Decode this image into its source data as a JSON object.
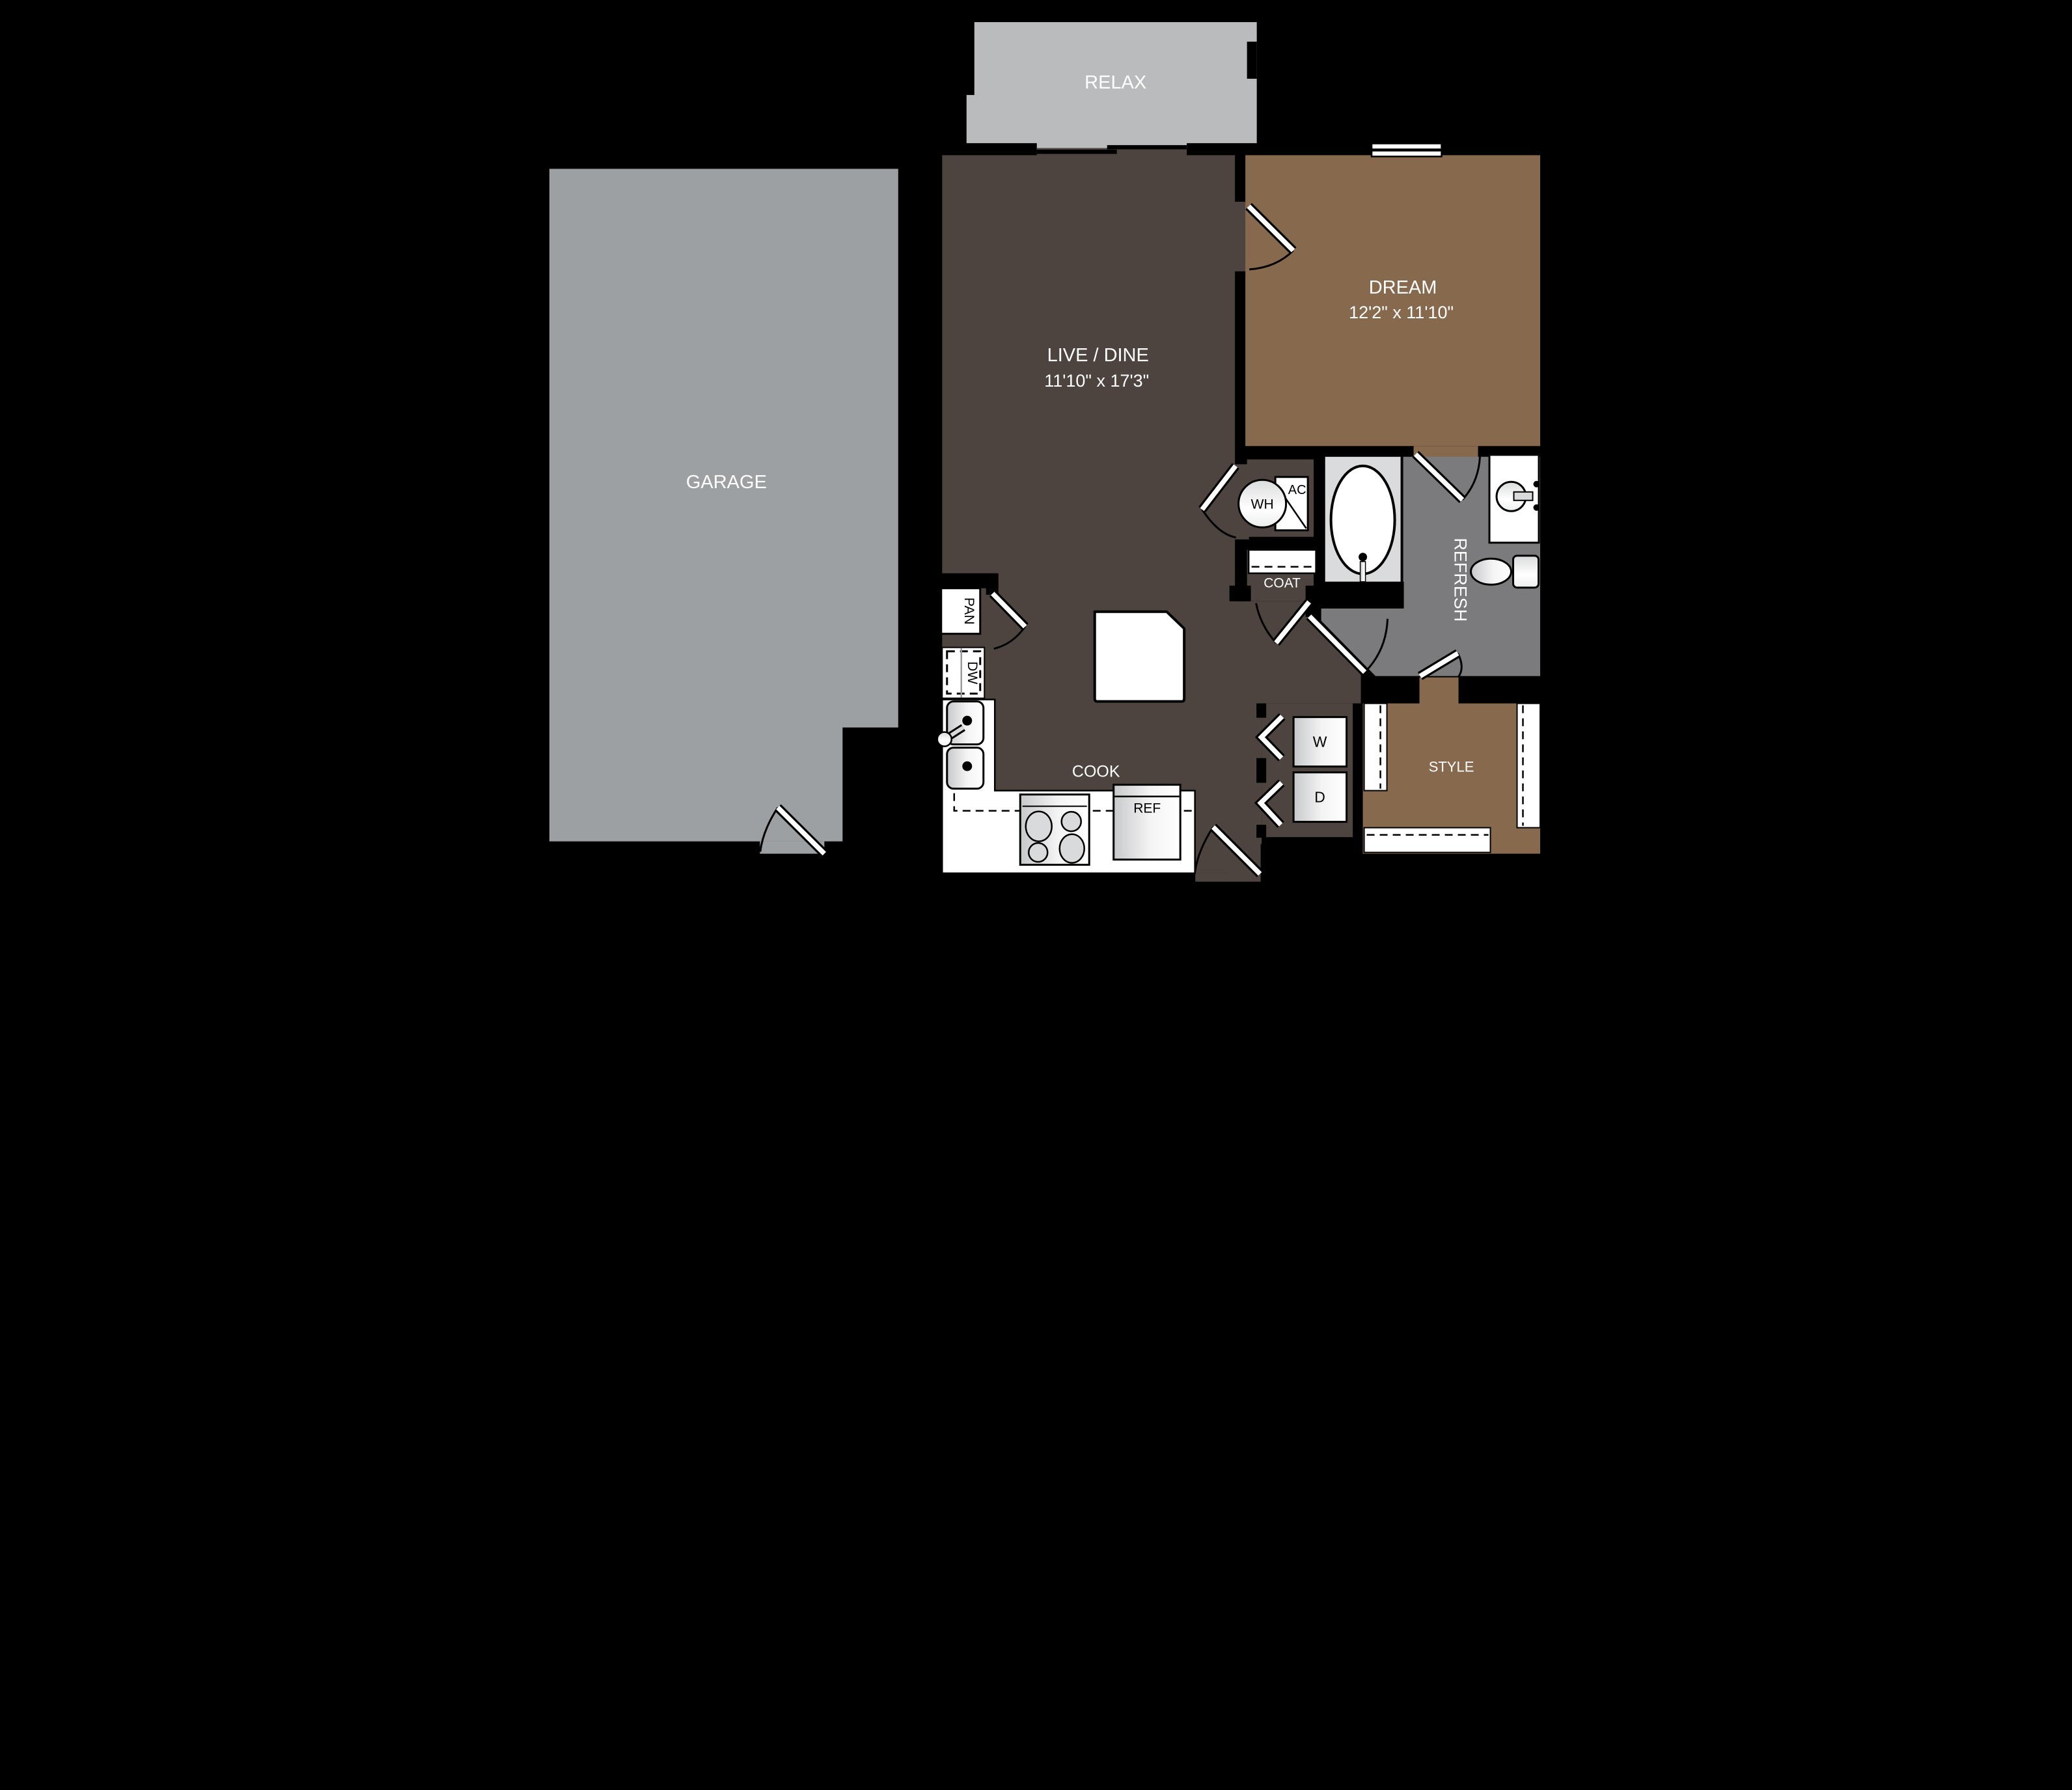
{
  "plan_title": "One-bedroom apartment floor plan with attached garage",
  "colors": {
    "background": "#000000",
    "relax_floor": "#b9bbbd",
    "garage_floor": "#9da0a2",
    "dark_floor": "#4d443f",
    "dream_floor": "#876a4e",
    "bath_floor": "#7b7b7d",
    "tub_niche": "#dadbdd",
    "fixture_white": "#ffffff",
    "label_white": "#ffffff",
    "label_black": "#000000"
  },
  "rooms": {
    "relax": {
      "label": "RELAX"
    },
    "garage": {
      "label": "GARAGE"
    },
    "live_dine": {
      "label": "LIVE / DINE",
      "dims": "11'10\" x 17'3\""
    },
    "dream": {
      "label": "DREAM",
      "dims": "12'2\" x 11'10\""
    },
    "cook": {
      "label": "COOK"
    },
    "coat": {
      "label": "COAT"
    },
    "refresh": {
      "label": "REFRESH"
    },
    "style": {
      "label": "STYLE"
    }
  },
  "fixtures": {
    "water_heater": "WH",
    "air_conditioner": "AC",
    "pantry": "PAN",
    "dishwasher": "DW",
    "washer": "W",
    "dryer": "D",
    "refrigerator": "REF"
  }
}
